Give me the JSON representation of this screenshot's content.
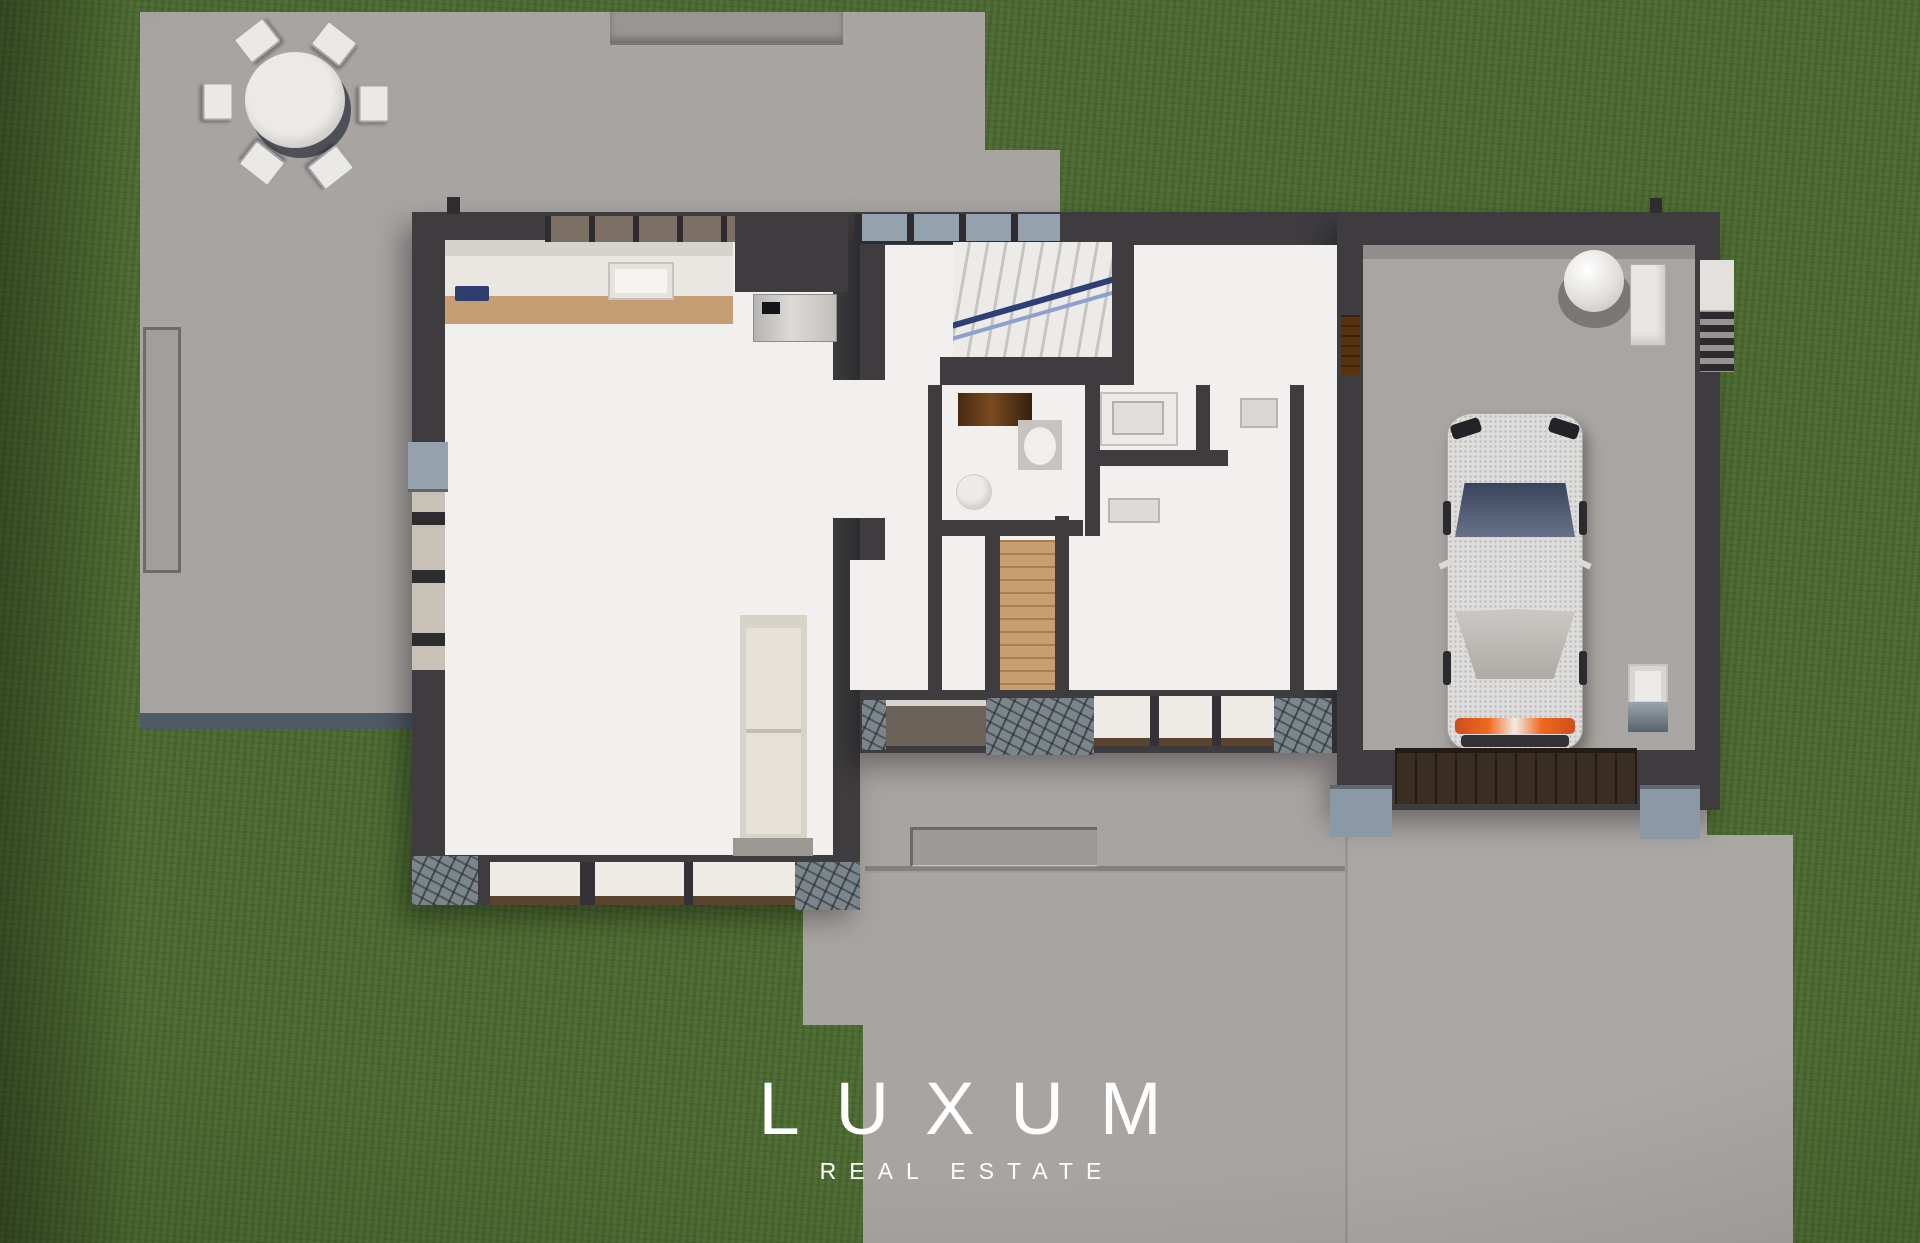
{
  "watermark": {
    "brand": "LUXUM",
    "tagline": "REAL ESTATE"
  },
  "scene": {
    "view": "top-down 3D architectural floor plan render on a lawn",
    "areas": {
      "patio": "paved terrace with round dining table and six chairs",
      "kitchen": "counter run with sink, cooktop and fridge column",
      "living_room": "open room with fireplace column and window walls",
      "entry": "glazed entry door and straight staircase with blue handrail",
      "powder_room": "toilet, basin and timber vanity",
      "laundry": "counter with inset sink",
      "bedroom": "room with desk and timber-floor closet",
      "garage": "single bay with parked car, water heater and utility sink",
      "driveway": "concrete apron, entry walkway and steps"
    }
  },
  "palette": {
    "grass": "#4d6a33",
    "paving": "#a8a4a2",
    "walls": "#3e3c3f",
    "interior_floor": "#f2f0ee",
    "cabinet_tan": "#c49d73",
    "timber_dark": "#57320f",
    "stone": "#7b858b",
    "steel_blue_piers": "#8b99a7",
    "stair_rail_blue": "#2f3f75",
    "glass": "#93a2ac",
    "car_accent_orange": "#ef6a1f",
    "logo_text": "#ffffff"
  }
}
